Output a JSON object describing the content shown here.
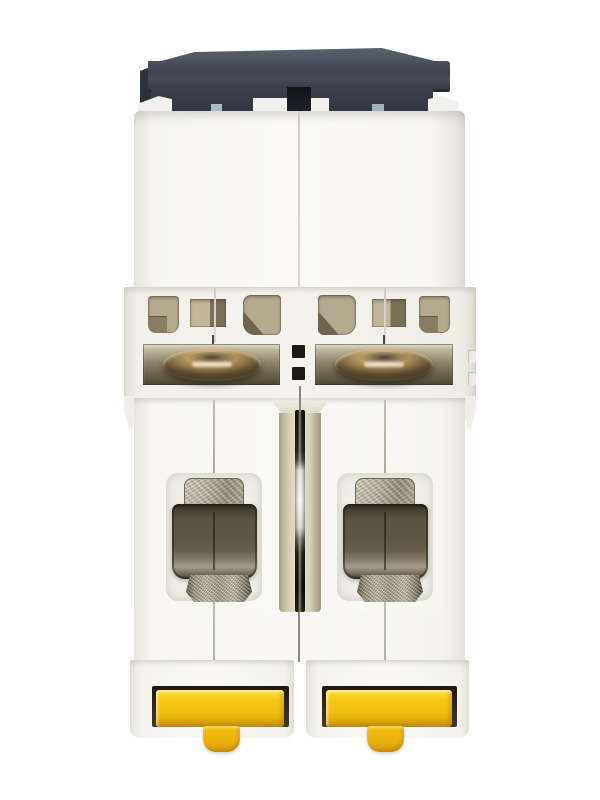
{
  "image": {
    "type": "product-photo",
    "subject": "Two-pole DIN-rail miniature circuit breaker viewed from the terminal side",
    "background": "#ffffff"
  },
  "parts": {
    "device": "2-pole miniature circuit breaker",
    "top_cap": "dark housing top cap",
    "upper_body": "white molded housing upper half",
    "vents": "ventilation and inspection openings",
    "screw_left": "pole 1 terminal screw head",
    "screw_right": "pole 2 terminal screw head",
    "channel": "center coupling channel with metal pin",
    "terminal_left": "pole 1 wire clamp terminal",
    "terminal_right": "pole 2 wire clamp terminal",
    "lower_body": "white molded housing lower half",
    "din_clip_left": "pole 1 yellow DIN-rail clip",
    "din_clip_right": "pole 2 yellow DIN-rail clip"
  },
  "colors": {
    "background": "#ffffff",
    "cap_dark": "#3c434e",
    "cap_band": "#303742",
    "cap_blue_tab": "#a9bcc7",
    "housing_white": "#fbfaf7",
    "housing_shadow": "#ddd9d1",
    "seam": "#cfccc5",
    "vent_tan": "#b4aa8f",
    "vent_dark": "#6e6450",
    "slot_dark": "#5f5740",
    "screw_brass_light": "#f0e0b4",
    "screw_brass": "#b7975f",
    "screw_brass_dark": "#50412a",
    "channel_tan": "#ded8c1",
    "pin_silver": "#eeedea",
    "terminal_dark": "#5e5746",
    "terminal_gloss": "#a49b89",
    "metal_silver": "#b5ae9c",
    "clip_recess": "#1d1810",
    "clip_yellow": "#f7c815",
    "clip_yellow_dark": "#d9a50a"
  }
}
